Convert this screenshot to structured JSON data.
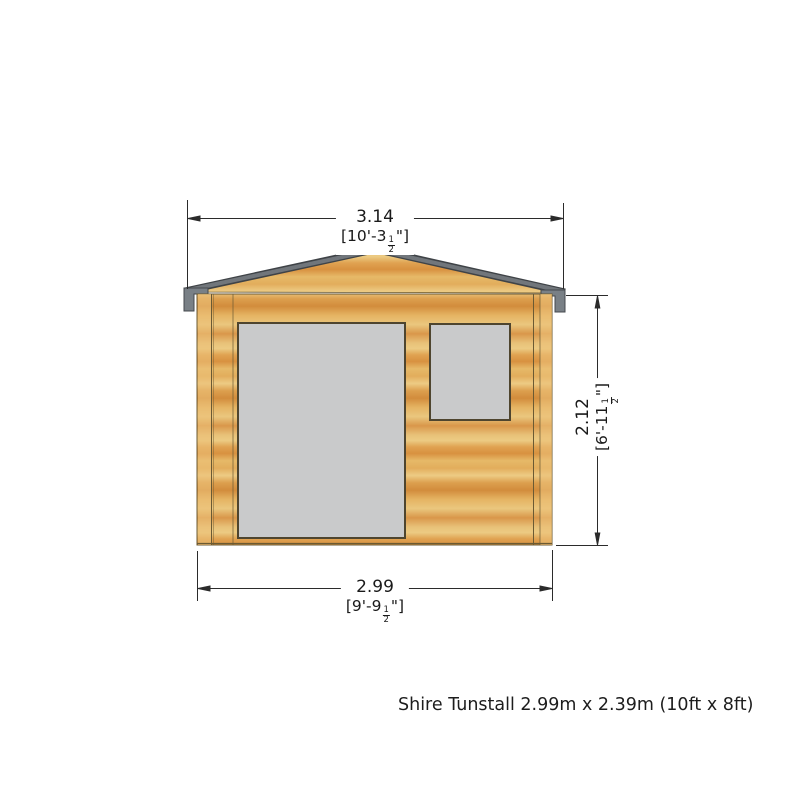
{
  "diagram": {
    "caption": "Shire Tunstall 2.99m x 2.39m (10ft x 8ft)",
    "building": {
      "type": "log-cabin-front-elevation",
      "parts": [
        "roof",
        "gable",
        "wall",
        "double-door",
        "window"
      ],
      "colors": {
        "wood_light": "#ecc87f",
        "wood_mid": "#e2ad5c",
        "wood_dark": "#d28c3c",
        "fascia_grey": "#71767b",
        "bracket_grey": "#798086",
        "glazing_grey": "#c9cacb",
        "outline_brown": "#6b5a33",
        "frame_dark": "#4e452f",
        "dimension_line": "#2b2b2b",
        "background": "#ffffff"
      }
    },
    "dimensions": {
      "roof_width": {
        "metric": "3.14",
        "imperial_prefix": "[10'-3",
        "fraction_numerator": "1",
        "fraction_denominator": "2",
        "imperial_suffix": "\"]"
      },
      "wall_height": {
        "metric": "2.12",
        "imperial_prefix": "[6'-11",
        "fraction_numerator": "1",
        "fraction_denominator": "2",
        "imperial_suffix": "\"]"
      },
      "base_width": {
        "metric": "2.99",
        "imperial_prefix": "[9'-9",
        "fraction_numerator": "1",
        "fraction_denominator": "2",
        "imperial_suffix": "\"]"
      }
    }
  }
}
